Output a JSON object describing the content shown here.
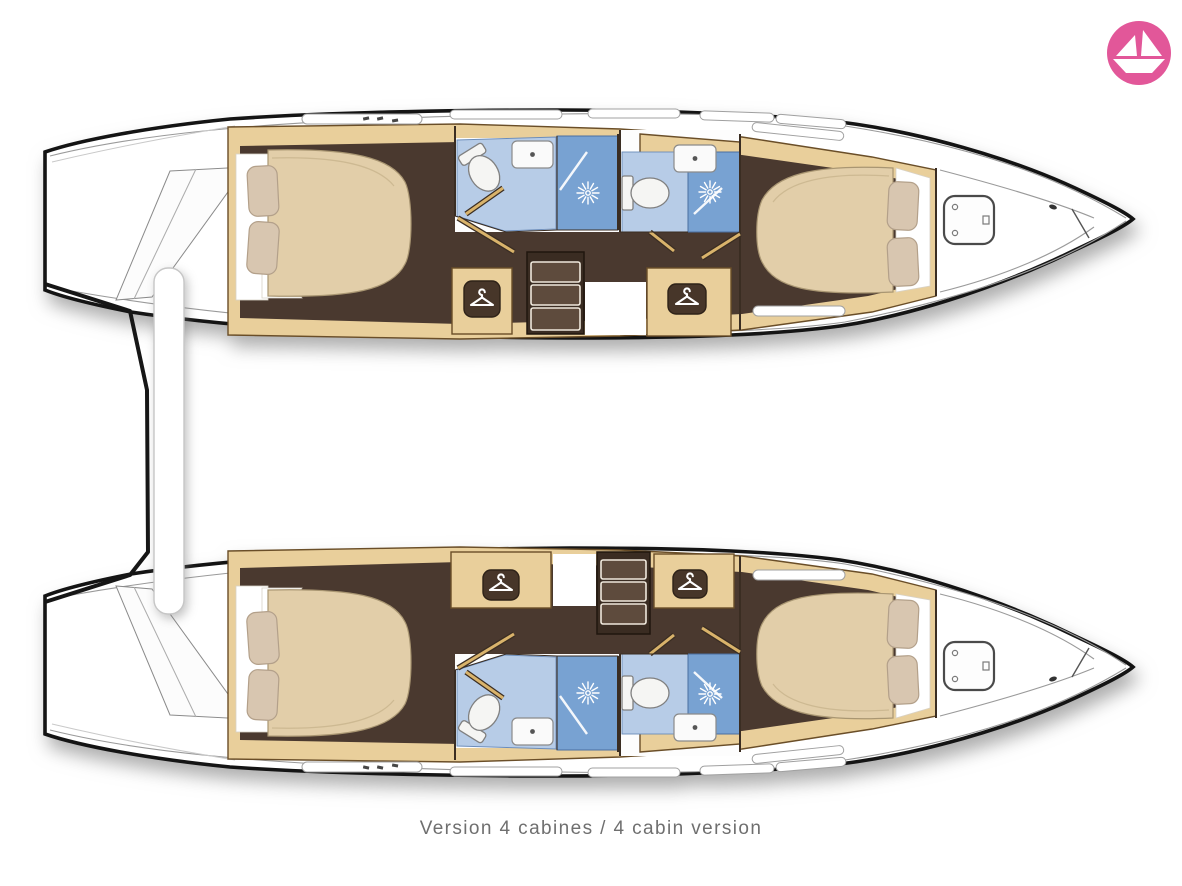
{
  "caption": "Version 4 cabines / 4 cabin version",
  "brand": {
    "icon": "paper-boat-icon",
    "circle_color": "#e25799",
    "glyph_color": "#ffffff"
  },
  "plan": {
    "vessel_type": "catamaran",
    "view": "hull deck plan, bow to the right, stern to the left",
    "hulls": [
      {
        "id": "port-hull",
        "position": "top",
        "rooms": [
          {
            "name": "aft-double-cabin",
            "features": [
              "double-bed",
              "two-pillows"
            ]
          },
          {
            "name": "aft-head",
            "features": [
              "toilet",
              "sink",
              "shower"
            ]
          },
          {
            "name": "wardrobe",
            "icon": "hanger-icon"
          },
          {
            "name": "companionway-steps"
          },
          {
            "name": "wardrobe",
            "icon": "hanger-icon"
          },
          {
            "name": "forward-head",
            "features": [
              "toilet",
              "sink",
              "shower"
            ]
          },
          {
            "name": "forward-double-cabin",
            "features": [
              "double-bed",
              "two-pillows"
            ]
          },
          {
            "name": "bow-locker",
            "features": [
              "deck-hatch"
            ]
          }
        ]
      },
      {
        "id": "starboard-hull",
        "position": "bottom",
        "rooms": [
          {
            "name": "aft-double-cabin",
            "features": [
              "double-bed",
              "two-pillows"
            ]
          },
          {
            "name": "aft-head",
            "features": [
              "toilet",
              "sink",
              "shower"
            ]
          },
          {
            "name": "wardrobe",
            "icon": "hanger-icon"
          },
          {
            "name": "companionway-steps"
          },
          {
            "name": "wardrobe",
            "icon": "hanger-icon"
          },
          {
            "name": "forward-head",
            "features": [
              "toilet",
              "sink",
              "shower"
            ]
          },
          {
            "name": "forward-double-cabin",
            "features": [
              "double-bed",
              "two-pillows"
            ]
          },
          {
            "name": "bow-locker",
            "features": [
              "deck-hatch"
            ]
          }
        ]
      }
    ],
    "between_hulls": [
      "stern-crossbeam",
      "transom-platform"
    ]
  },
  "colors": {
    "hull_outline": "#141414",
    "wood_trim": "#e9cf9b",
    "floor_dark": "#4a392f",
    "bath_light_blue": "#b7cce7",
    "shower_blue": "#78a2d2",
    "mattress": "#e2cea9",
    "caption_text": "#6f6f6f",
    "logo_pink": "#e25799"
  }
}
